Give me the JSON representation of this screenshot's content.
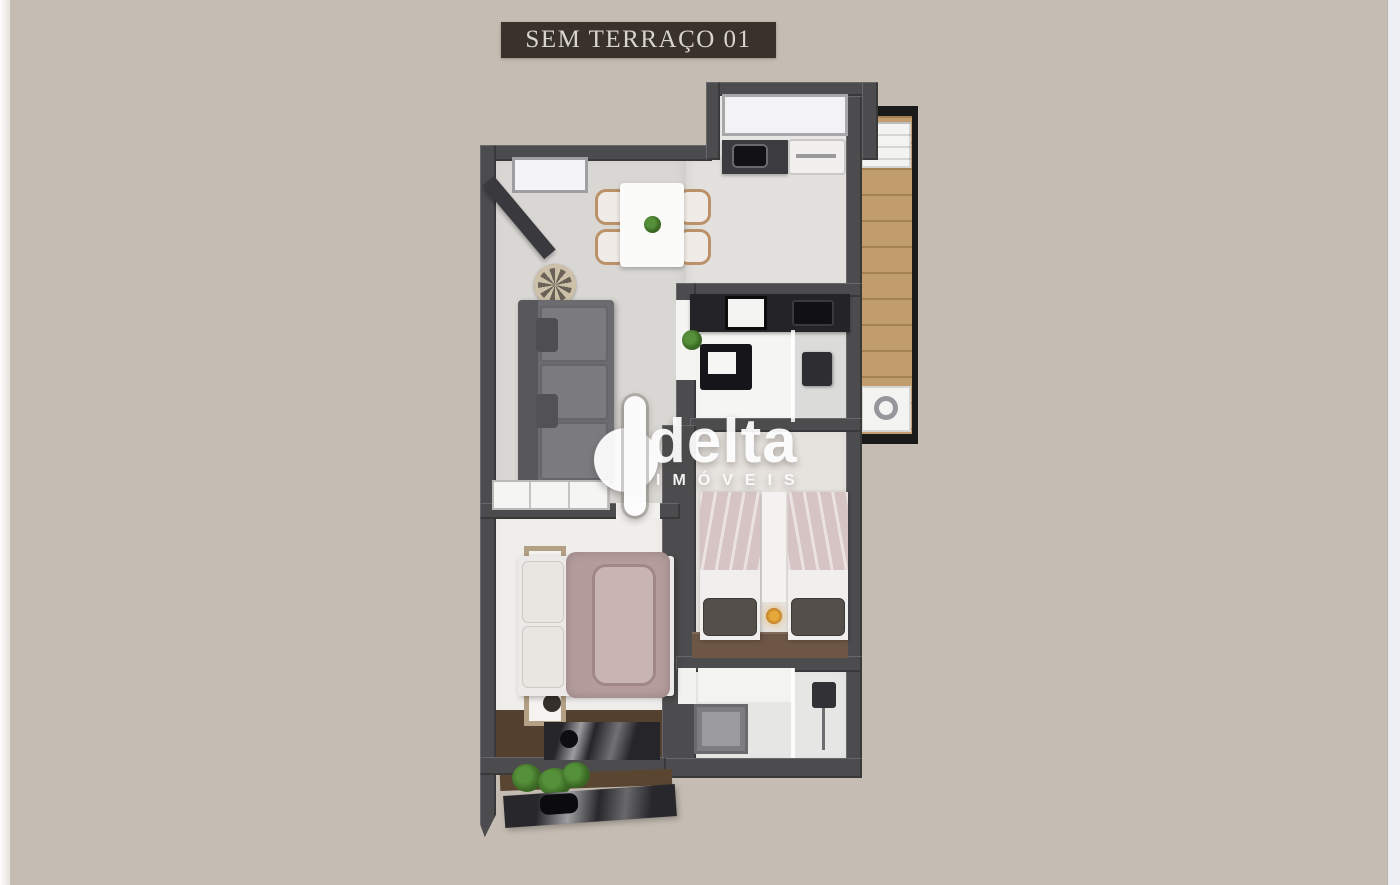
{
  "banner": {
    "label": "SEM TERRAÇO 01"
  },
  "watermark": {
    "brand": "delta",
    "subtitle": "IMÓVEIS"
  },
  "plan": {
    "rooms": [
      "living-dining",
      "kitchen",
      "service-balcony",
      "bathroom-suite",
      "double-bedroom",
      "twin-bedroom",
      "bathroom-social",
      "lower-balcony"
    ],
    "colors": {
      "background": "#c5bdb3",
      "edge_strip_left": "#fbfbfc",
      "edge_strip_right": "#edeff5",
      "banner_bg": "#39312b",
      "banner_text": "#d9d4ce",
      "wall": "#4c4c4e",
      "balcony_frame": "#1a1a1a",
      "wood_floor": "#c19d6d",
      "living_floor": "#d9d7d3",
      "kitchen_floor": "#e3e1dd",
      "bedroom_floor": "#f0eeeb",
      "bathroom_counter": "#242428",
      "sofa": "#6c6c70",
      "duvet_mauve": "#b49c9c",
      "twin_blanket": "#d6c4c4",
      "headboard_wood": "#6d5646",
      "desk_wood": "#53402f",
      "plant_green": "#3e7a20",
      "watermark_white": "#fdfdfd"
    }
  }
}
